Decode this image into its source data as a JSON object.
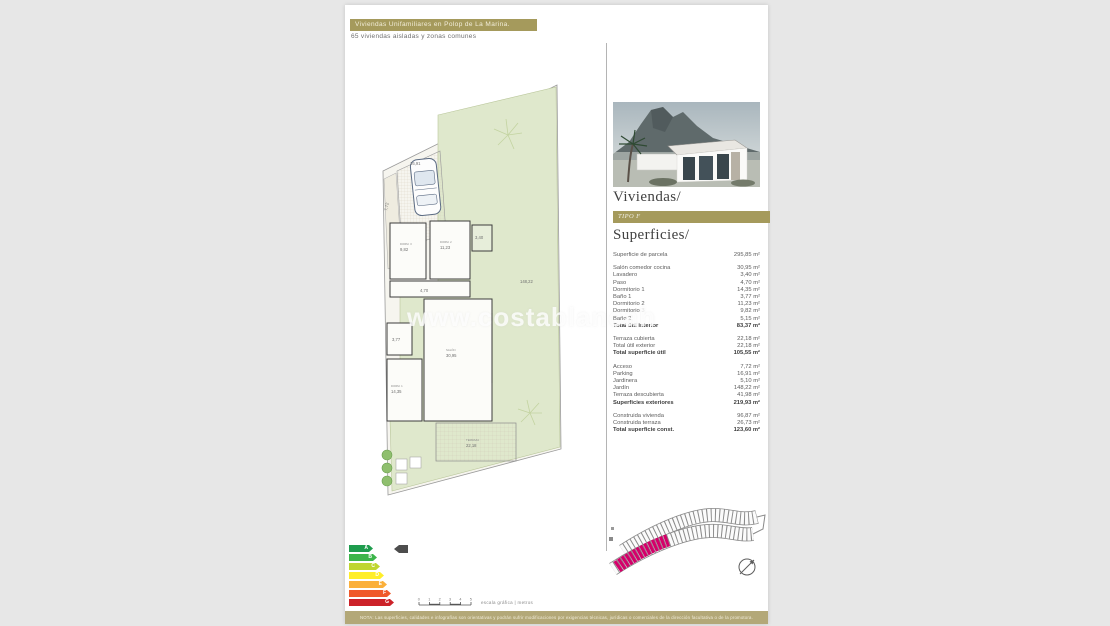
{
  "header": {
    "banner_title": "Viviendas Unifamiliares en Polop de La Marina.",
    "subtitle": "65 viviendas aisladas y zonas comunes"
  },
  "watermark": "www.costablancah",
  "plan": {
    "labels": {
      "acceso": "7,72",
      "parking": "16,91",
      "jardin": "148,22",
      "dormitorio3": "9,82",
      "dormitorio2": "11,23",
      "lavadero": "3,40",
      "paso": "4,70",
      "bano1": "3,77",
      "dormitorio1": "14,35",
      "salon": "30,95",
      "terraza": "22,18"
    }
  },
  "right_panel": {
    "title": "Viviendas/",
    "type_badge": "TIPO F",
    "superficies_title": "Superficies/",
    "surface_sections": [
      {
        "rows": [
          {
            "label": "Superficie de parcela",
            "value": "295,85 m²",
            "bold": false
          }
        ]
      },
      {
        "rows": [
          {
            "label": "Salón comedor cocina",
            "value": "30,95 m²",
            "bold": false
          },
          {
            "label": "Lavadero",
            "value": "3,40 m²",
            "bold": false
          },
          {
            "label": "Paso",
            "value": "4,70 m²",
            "bold": false
          },
          {
            "label": "Dormitorio 1",
            "value": "14,35 m²",
            "bold": false
          },
          {
            "label": "Baño 1",
            "value": "3,77 m²",
            "bold": false
          },
          {
            "label": "Dormitorio 2",
            "value": "11,23 m²",
            "bold": false
          },
          {
            "label": "Dormitorio 3",
            "value": "9,82 m²",
            "bold": false
          },
          {
            "label": "Baño 2",
            "value": "5,15 m²",
            "bold": false
          },
          {
            "label": "Total útil interior",
            "value": "83,37 m²",
            "bold": true
          }
        ]
      },
      {
        "rows": [
          {
            "label": "Terraza cubierta",
            "value": "22,18 m²",
            "bold": false
          },
          {
            "label": "Total útil exterior",
            "value": "22,18 m²",
            "bold": false
          },
          {
            "label": "Total superficie útil",
            "value": "105,55 m²",
            "bold": true
          }
        ]
      },
      {
        "rows": [
          {
            "label": "Acceso",
            "value": "7,72 m²",
            "bold": false
          },
          {
            "label": "Parking",
            "value": "16,91 m²",
            "bold": false
          },
          {
            "label": "Jardinera",
            "value": "5,10 m²",
            "bold": false
          },
          {
            "label": "Jardín",
            "value": "148,22 m²",
            "bold": false
          },
          {
            "label": "Terraza descubierta",
            "value": "41,98 m²",
            "bold": false
          },
          {
            "label": "Superficies exteriores",
            "value": "219,93 m²",
            "bold": true
          }
        ]
      },
      {
        "rows": [
          {
            "label": "Construida vivienda",
            "value": "96,87 m²",
            "bold": false
          },
          {
            "label": "Construida terraza",
            "value": "26,73 m²",
            "bold": false
          },
          {
            "label": "Total superficie const.",
            "value": "123,60 m²",
            "bold": true
          }
        ]
      }
    ]
  },
  "energy_label": {
    "bars": [
      {
        "letter": "A",
        "color": "#1e9c4d",
        "width": 24
      },
      {
        "letter": "B",
        "color": "#3cb54a",
        "width": 28
      },
      {
        "letter": "C",
        "color": "#bfd630",
        "width": 31
      },
      {
        "letter": "D",
        "color": "#ffee29",
        "width": 35
      },
      {
        "letter": "E",
        "color": "#fbb03b",
        "width": 38
      },
      {
        "letter": "F",
        "color": "#f0592a",
        "width": 42
      },
      {
        "letter": "G",
        "color": "#cc2229",
        "width": 45
      }
    ],
    "marker_color": "#4d4d4d"
  },
  "scale_bar": {
    "ticks": [
      "0",
      "1",
      "2",
      "3",
      "4",
      "5"
    ],
    "caption": "escala gráfica | metros"
  },
  "site_plan": {
    "highlight_color": "#d4006a"
  },
  "footer": {
    "disclaimer": "NOTA: Las superficies, calidades e infografías son orientativas y podrán sufrir modificaciones por exigencias técnicas, jurídicas o comerciales de la dirección facultativa o de la promotora."
  }
}
